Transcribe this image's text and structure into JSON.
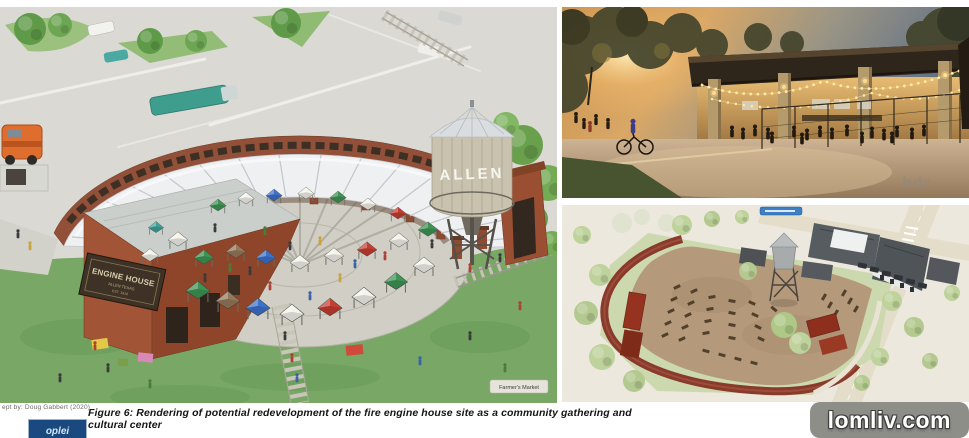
{
  "figure": {
    "credit": "ept by: Doug Gabbert (2020)",
    "caption": "Figure 6: Rendering of potential redevelopment of the fire engine house site as a community gathering and cultural center",
    "logo_text": "oplei"
  },
  "watermark": {
    "text": "lomliv.com",
    "bg": "#8e8e89"
  },
  "left_image": {
    "sign": {
      "line1": "ENGINE HOUSE",
      "line2": "ALLEN TEXAS",
      "line3": "EST. 1910"
    },
    "water_tower_label": "ALLEN",
    "map_label": "Farmer's Market"
  },
  "top_right_image": {
    "watermark_text": "bdr"
  },
  "colors": {
    "brick": "#9a4f33",
    "lawn": "#78a766",
    "plaza": "#d0cec5",
    "site_plan_dirt": "#b49a7b",
    "track_red": "#8a3a2b",
    "logo_blue": "#19497f"
  }
}
